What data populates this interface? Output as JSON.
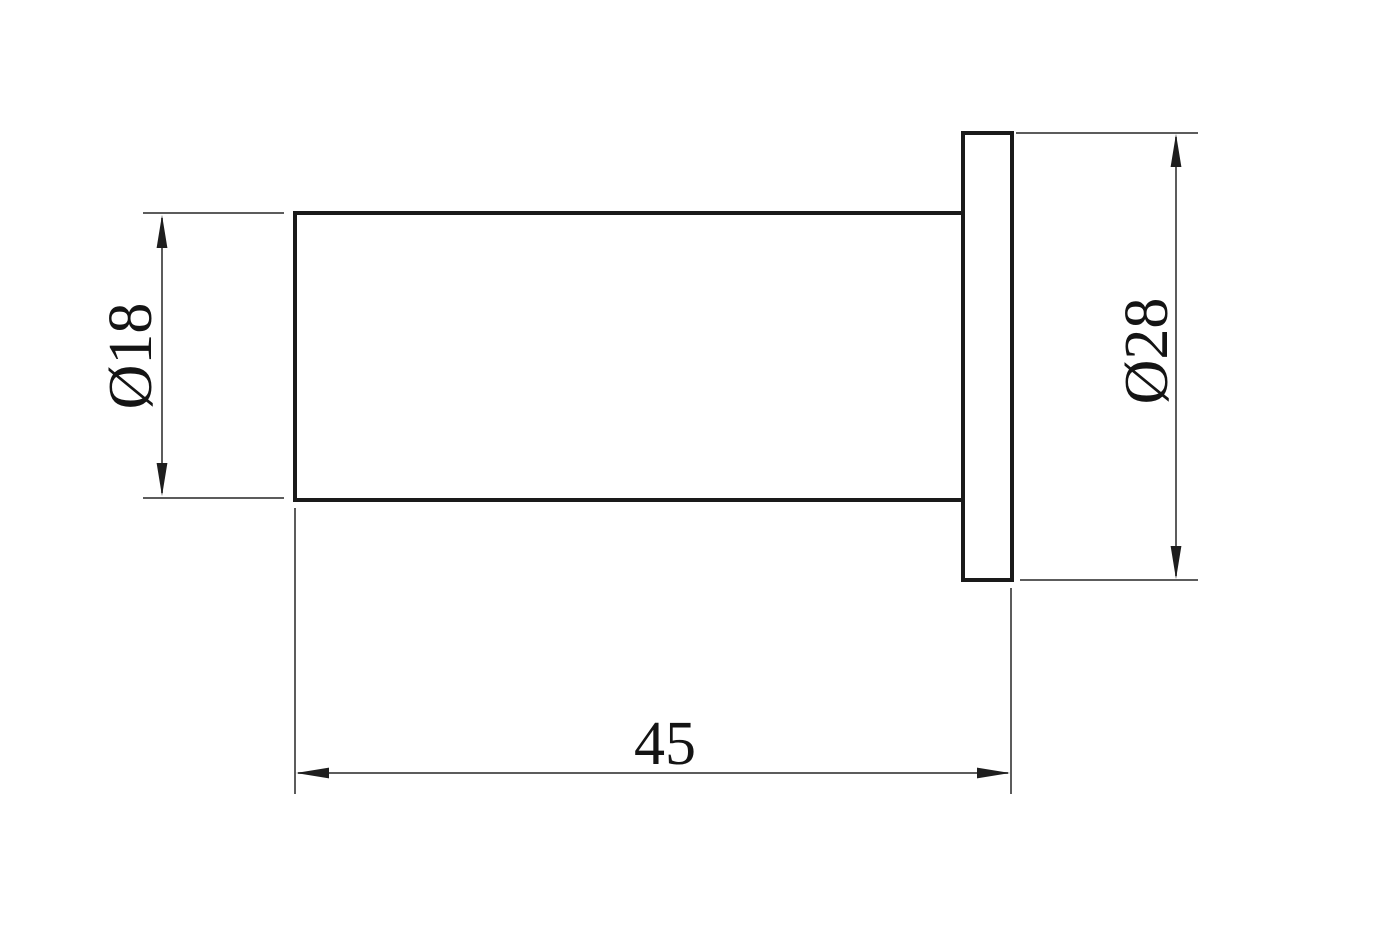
{
  "drawing": {
    "description": "2D technical dimension drawing: side view of a flanged cylindrical part (shaft with round wall flange)",
    "background_color": "#ffffff",
    "outline_color": "#1a1a1a",
    "dimension_line_color": "#5c5c5c",
    "arrowhead_color": "#1e1e1e",
    "text_color": "#141414",
    "dimensions": {
      "shaft_diameter": {
        "label": "Ø18",
        "value": 18
      },
      "flange_diameter": {
        "label": "Ø28",
        "value": 28
      },
      "overall_length": {
        "label": "45",
        "value": 45
      }
    }
  }
}
